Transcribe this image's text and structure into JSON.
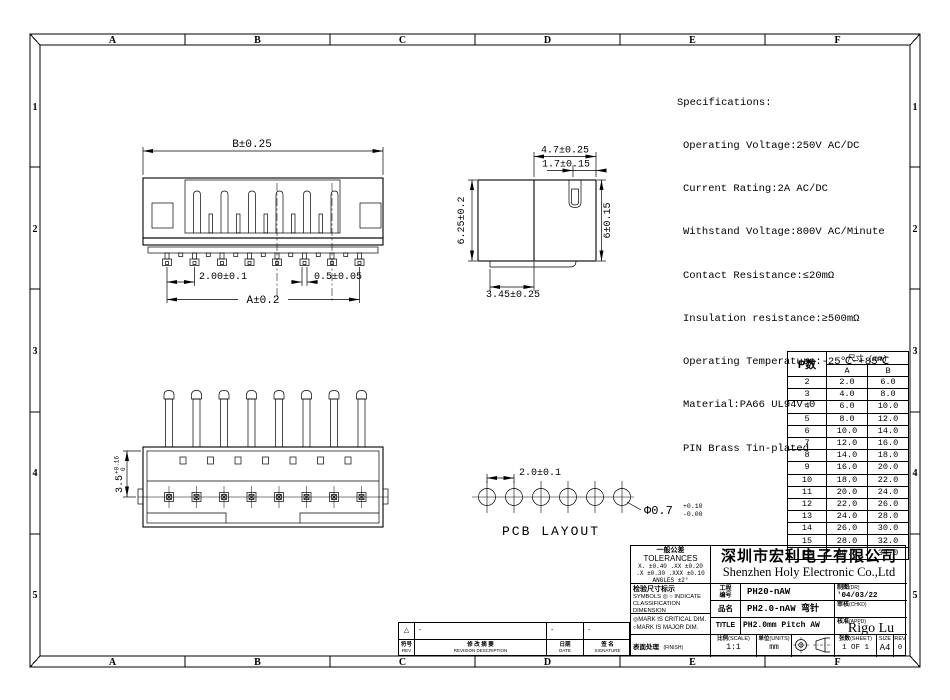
{
  "frame": {
    "cols": [
      "A",
      "B",
      "C",
      "D",
      "E",
      "F"
    ],
    "rows": [
      "1",
      "2",
      "3",
      "4",
      "5"
    ]
  },
  "specs": {
    "title": "Specifications:",
    "lines": [
      "Operating Voltage:250V AC/DC",
      "Current Rating:2A AC/DC",
      "Withstand Voltage:800V AC/Minute",
      "Contact Resistance:≤20mΩ",
      "Insulation resistance:≥500mΩ",
      "Operating Temperature:-25℃~+85℃",
      "Material:PA66 UL94V-0",
      "PIN Brass Tin-plated"
    ]
  },
  "views": {
    "front": {
      "dim_width_top": "B±0.25",
      "dim_pitch": "2.00±0.1",
      "dim_pin_width": "0.5±0.05",
      "dim_width_bottom": "A±0.2"
    },
    "side": {
      "dim_top_width": "4.7±0.25",
      "dim_slot": "1.7±0.15",
      "dim_height_left": "6.25±0.2",
      "dim_height_right": "6±0.15",
      "dim_pin_length": "3.45±0.25"
    },
    "top": {
      "dim_depth": "3.5",
      "dim_depth_tol_upper": "+0.16",
      "dim_depth_tol_lower": "0"
    },
    "pcb": {
      "caption": "PCB LAYOUT",
      "dim_pitch": "2.0±0.1",
      "dim_hole_dia": "Φ0.7",
      "dim_hole_tol_upper": "+0.10",
      "dim_hole_tol_lower": "-0.00"
    }
  },
  "size_table": {
    "header_pins": "P数",
    "header_dim": "尺寸 (mm)",
    "header_a": "A",
    "header_b": "B",
    "rows": [
      [
        "2",
        "2.0",
        "6.0"
      ],
      [
        "3",
        "4.0",
        "8.0"
      ],
      [
        "4",
        "6.0",
        "10.0"
      ],
      [
        "5",
        "8.0",
        "12.0"
      ],
      [
        "6",
        "10.0",
        "14.0"
      ],
      [
        "7",
        "12.0",
        "16.0"
      ],
      [
        "8",
        "14.0",
        "18.0"
      ],
      [
        "9",
        "16.0",
        "20.0"
      ],
      [
        "10",
        "18.0",
        "22.0"
      ],
      [
        "11",
        "20.0",
        "24.0"
      ],
      [
        "12",
        "22.0",
        "26.0"
      ],
      [
        "13",
        "24.0",
        "28.0"
      ],
      [
        "14",
        "26.0",
        "30.0"
      ],
      [
        "15",
        "28.0",
        "32.0"
      ],
      [
        "16",
        "30.0",
        "34.0"
      ]
    ]
  },
  "title_block": {
    "tolerances": {
      "title_cn": "一般公差",
      "title_en": "TOLERANCES",
      "line1": "X. ±0.40   .XX ±0.20",
      "line2": ".X ±0.30  .XXX ±0.10",
      "line3": "ANGLES    ±2°"
    },
    "symbols_note": {
      "title": "检验尺寸标示",
      "line1": "SYMBOLS ◎ ○ INDICATE",
      "line2": "CLASSIFICATION DIMENSION"
    },
    "marks": {
      "line1": "◎MARK IS CRITICAL DIM.",
      "line2": "○MARK IS MAJOR DIM."
    },
    "finish": {
      "label_cn": "表面处理",
      "label_en": "(FINISH)",
      "value": ""
    },
    "company_cn": "深圳市宏利电子有限公司",
    "company_en": "Shenzhen Holy Electronic Co.,Ltd",
    "part_no": {
      "label": "工程编号",
      "value": "PH20-nAW"
    },
    "product_name": {
      "label": "品名",
      "value": "PH2.0-nAW 弯针"
    },
    "title_row": {
      "label": "TITLE",
      "value": "PH2.0mm  Pitch AW DIP CONN"
    },
    "drawn": {
      "label_cn": "制图",
      "label_en": "(DR)",
      "value": "'04/03/22"
    },
    "checked": {
      "label_cn": "审核",
      "label_en": "(CHKD)",
      "value": ""
    },
    "approved": {
      "label_cn": "核准",
      "label_en": "(APPD)",
      "value": "Rigo Lu"
    },
    "scale": {
      "label_cn": "比例",
      "label_en": "(SCALE)",
      "value": "1:1"
    },
    "units": {
      "label_cn": "单位",
      "label_en": "(UNITS)",
      "value": "mm"
    },
    "sheet": {
      "label_cn": "张数",
      "label_en": "(SHEET)",
      "value": "1 OF 1"
    },
    "size": {
      "label": "SIZE",
      "value": "A4"
    },
    "rev": {
      "label": "REV",
      "value": "0"
    }
  },
  "revision_strip": {
    "entry": {
      "symbol": "△",
      "desc": "-",
      "date": "-",
      "sig": "-"
    },
    "headers": {
      "rev_cn": "符号",
      "rev_en": "REV",
      "desc_cn": "修 改 摘 要",
      "desc_en": "REVISION DESCRIPTION",
      "date_cn": "日期",
      "date_en": "DATE",
      "sig_cn": "签 名",
      "sig_en": "SIGNATURE"
    }
  }
}
